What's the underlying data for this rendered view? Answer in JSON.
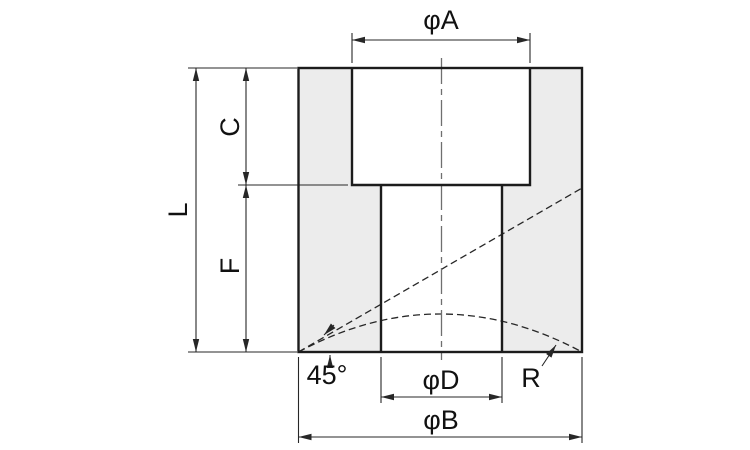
{
  "labels": {
    "dia_a": "φA",
    "dia_b": "φB",
    "dia_d": "φD",
    "overall_length": "L",
    "counterbore_depth": "C",
    "remaining_length": "F",
    "chamfer_angle": "45°",
    "corner_radius": "R"
  },
  "colors": {
    "background": "#ffffff",
    "material_fill": "#ececec",
    "outline": "#1c1c1c",
    "thin": "#272727",
    "centerline": "#6f6f6f",
    "text": "#111111"
  }
}
